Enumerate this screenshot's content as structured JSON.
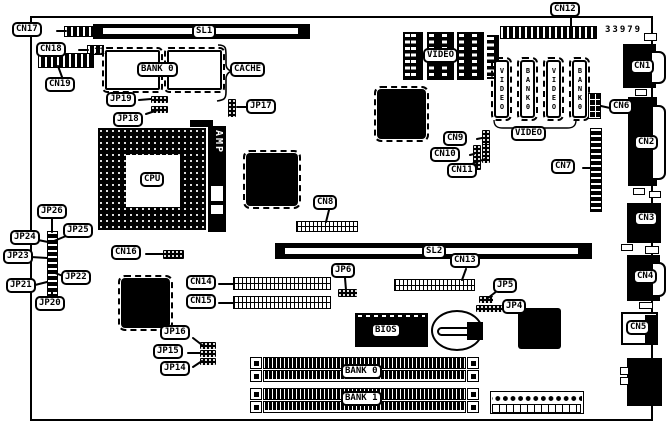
{
  "diagram": {
    "part_number": "33979",
    "pin1_marker": "11"
  },
  "slots": {
    "sl1": "SL1",
    "sl2": "SL2"
  },
  "connectors": {
    "cn1": "CN1",
    "cn2": "CN2",
    "cn3": "CN3",
    "cn4": "CN4",
    "cn5": "CN5",
    "cn6": "CN6",
    "cn7": "CN7",
    "cn8": "CN8",
    "cn9": "CN9",
    "cn10": "CN10",
    "cn11": "CN11",
    "cn12": "CN12",
    "cn13": "CN13",
    "cn14": "CN14",
    "cn15": "CN15",
    "cn16": "CN16",
    "cn17": "CN17",
    "cn18": "CN18",
    "cn19": "CN19"
  },
  "jumpers": {
    "jp4": "JP4",
    "jp5": "JP5",
    "jp6": "JP6",
    "jp14": "JP14",
    "jp15": "JP15",
    "jp16": "JP16",
    "jp17": "JP17",
    "jp18": "JP18",
    "jp19": "JP19",
    "jp20": "JP20",
    "jp21": "JP21",
    "jp22": "JP22",
    "jp23": "JP23",
    "jp24": "JP24",
    "jp25": "JP25",
    "jp26": "JP26"
  },
  "chips": {
    "cpu": "CPU",
    "amp": "AMP",
    "bios": "BIOS",
    "cache": "CACHE",
    "cache_bank": "BANK 0",
    "video_dip": "VIDEO",
    "video_group": "VIDEO",
    "simm_bank0": "BANK 0",
    "simm_bank1": "BANK 1"
  },
  "vertical_chips": [
    "VIDEO",
    "BANK0",
    "VIDEO",
    "BANK0"
  ]
}
